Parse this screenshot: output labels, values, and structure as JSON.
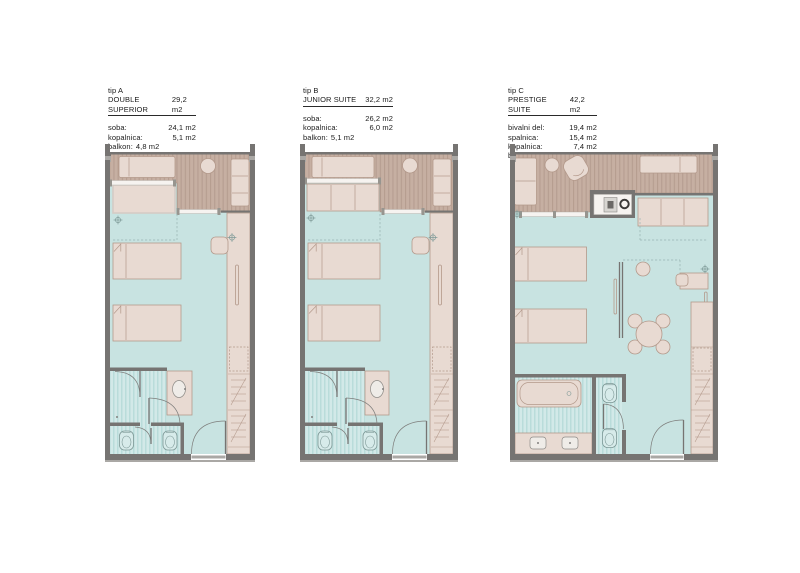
{
  "colors": {
    "wall": "#767472",
    "wallL": "#aaa8a5",
    "wood": "#c6afa2",
    "woodS": "#b59d90",
    "floor": "#c8e3e1",
    "furn": "#e8dad2",
    "furnL": "#b3998b",
    "white": "#f6f3f0",
    "bathA": "#b9dcda",
    "bathB": "#d2e9e8",
    "fix": "#d7ebea",
    "fixL": "#7d9896",
    "dash": "#98b4b2"
  },
  "plans": [
    {
      "tip": "tip A",
      "name": "DOUBLE SUPERIOR",
      "total_area": "29,2 m2",
      "rooms": [
        {
          "label": "soba:",
          "value": "24,1 m2"
        },
        {
          "label": "kopalnica:",
          "value": "5,1 m2"
        }
      ],
      "balcony": {
        "label": "balkon:",
        "value": "4,8 m2"
      }
    },
    {
      "tip": "tip B",
      "name": "JUNIOR SUITE",
      "total_area": "32,2 m2",
      "rooms": [
        {
          "label": "soba:",
          "value": "26,2 m2"
        },
        {
          "label": "kopalnica:",
          "value": "6,0 m2"
        }
      ],
      "balcony": {
        "label": "balkon:",
        "value": "5,1 m2"
      }
    },
    {
      "tip": "tip C",
      "name": "PRESTIGE SUITE",
      "total_area": "42,2 m2",
      "rooms": [
        {
          "label": "bivalni del:",
          "value": "19,4 m2"
        },
        {
          "label": "spalnica:",
          "value": "15,4 m2"
        },
        {
          "label": "kopalnica:",
          "value": "7,4 m2"
        }
      ],
      "balcony": {
        "label": "balkon:",
        "value": "7,6 m2"
      }
    }
  ]
}
